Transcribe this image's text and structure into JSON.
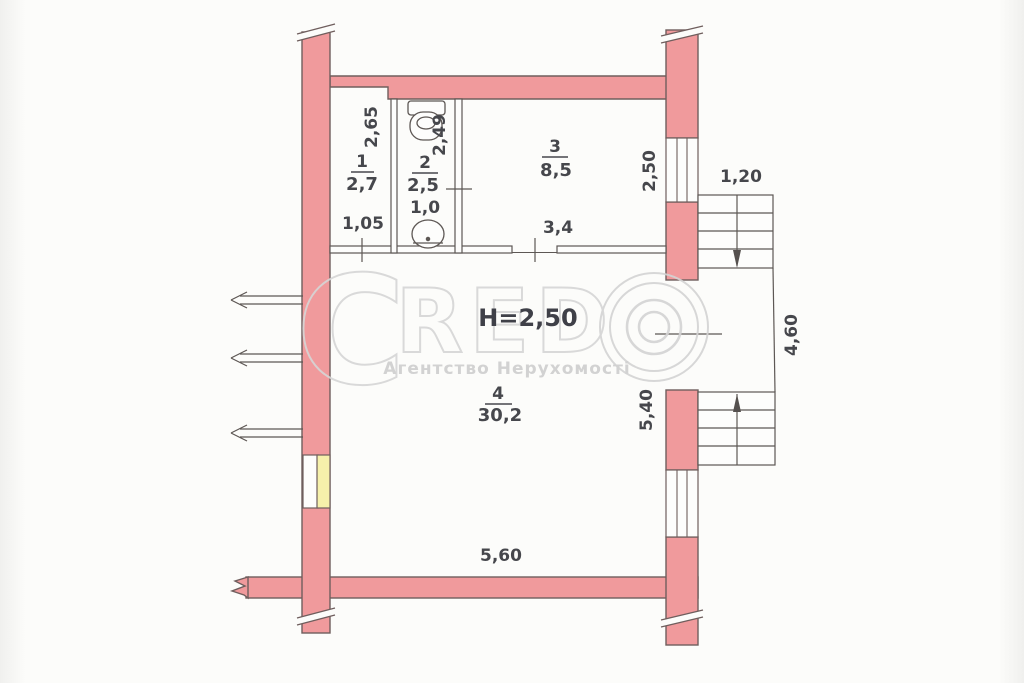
{
  "document": {
    "kind": "scanned apartment floor plan (BTI)",
    "ceiling_height_label": "H=2,50"
  },
  "watermark": {
    "letter_c": "C",
    "letters_red": "RED",
    "subtitle": "Агентство Нерухомості"
  },
  "rooms": [
    {
      "number": "1",
      "area": "2,7"
    },
    {
      "number": "2",
      "area": "2,5",
      "sub_area": "1,0"
    },
    {
      "number": "3",
      "area": "8,5"
    },
    {
      "number": "4",
      "area": "30,2"
    }
  ],
  "dims": {
    "room1_depth": "2,65",
    "room2_depth": "2,49",
    "room1_width": "1,05",
    "room3_depth": "2,50",
    "room3_width": "3,4",
    "stairs_width": "1,20",
    "stairs_length": "4,60",
    "room4_depth": "5,40",
    "room4_width": "5,60"
  },
  "colors": {
    "wall_fill": "#f09a9c",
    "wall_outline": "#6f5e5d",
    "blocked_opening": "#f6f1ab",
    "watermark": "#d6d6d6",
    "annotation_text": "#46474c"
  }
}
